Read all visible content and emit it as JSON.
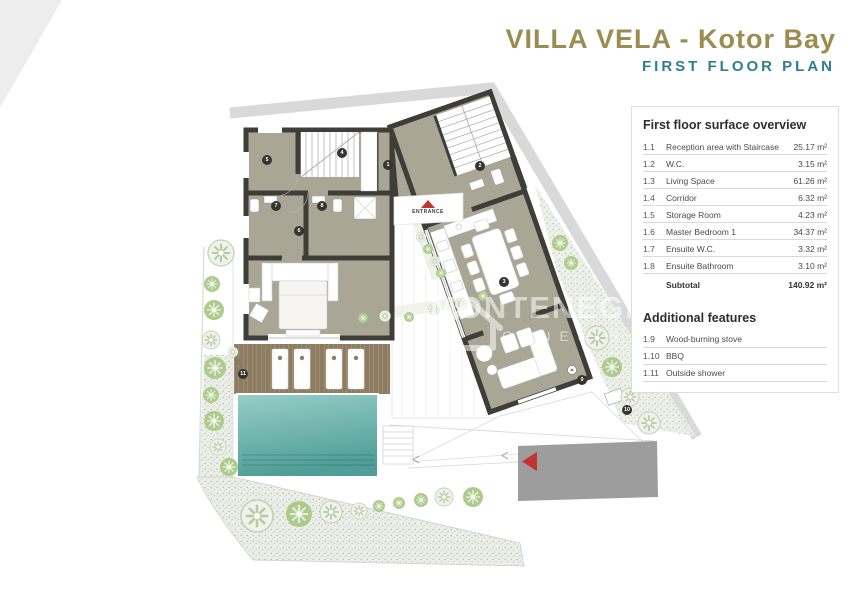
{
  "header": {
    "title": "VILLA VELA - Kotor Bay",
    "subtitle": "FIRST FLOOR PLAN"
  },
  "legend": {
    "title": "First floor surface overview",
    "rows": [
      {
        "no": "1.1",
        "name": "Reception area with Staircase",
        "area": "25.17 m²"
      },
      {
        "no": "1.2",
        "name": "W.C.",
        "area": "3.15 m²"
      },
      {
        "no": "1.3",
        "name": "Living Space",
        "area": "61.26 m²"
      },
      {
        "no": "1.4",
        "name": "Corridor",
        "area": "6.32 m²"
      },
      {
        "no": "1.5",
        "name": "Storage Room",
        "area": "4.23 m²"
      },
      {
        "no": "1.6",
        "name": "Master Bedroom 1",
        "area": "34.37 m²"
      },
      {
        "no": "1.7",
        "name": "Ensuite W.C.",
        "area": "3.32 m²"
      },
      {
        "no": "1.8",
        "name": "Ensuite Bathroom",
        "area": "3.10 m²"
      }
    ],
    "subtotal": {
      "label": "Subtotal",
      "area": "140.92 m²"
    }
  },
  "features": {
    "title": "Additional features",
    "rows": [
      {
        "no": "1.9",
        "name": "Wood-burning stove"
      },
      {
        "no": "1.10",
        "name": "BBQ"
      },
      {
        "no": "1.11",
        "name": "Outside shower"
      }
    ]
  },
  "plan": {
    "entrance_label": "ENTRANCE",
    "watermark_line1": "MONTENEGRO",
    "watermark_line2": "GENESIS",
    "badges": [
      "1",
      "2",
      "3",
      "4",
      "5",
      "6",
      "7",
      "8",
      "9",
      "10",
      "11"
    ],
    "colors": {
      "title_olive": "#9c8c52",
      "subtitle_teal": "#2f7e8c",
      "floor": "#a9a695",
      "wall": "#3e3d38",
      "pool": "#57a29b",
      "deck": "#8d7c60",
      "driveway": "#9d9d9d",
      "accent_red": "#c1352c"
    }
  }
}
